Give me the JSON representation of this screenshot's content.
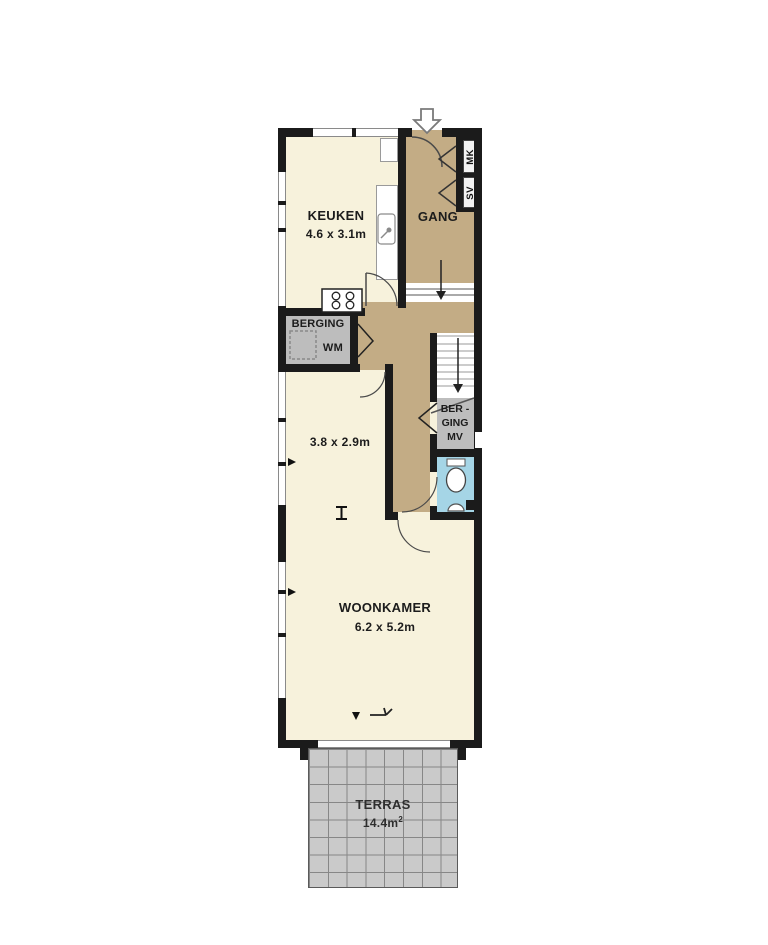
{
  "rooms": {
    "keuken": {
      "name": "KEUKEN",
      "dims": "4.6 x 3.1m"
    },
    "gang": {
      "name": "GANG"
    },
    "berging": {
      "name": "BERGING",
      "appliance": "WM"
    },
    "kamer": {
      "dims": "3.8 x 2.9m"
    },
    "berging_mv": {
      "line1": "BER -",
      "line2": "GING",
      "line3": "MV"
    },
    "woonkamer": {
      "name": "WOONKAMER",
      "dims": "6.2 x 5.2m"
    },
    "terras": {
      "name": "TERRAS",
      "area_value": "14.4m",
      "area_exp": "2"
    }
  },
  "closets": {
    "mk": "MK",
    "sv": "SV"
  },
  "colors": {
    "room_cream": "#f7f2dc",
    "hall_tan": "#c3ac85",
    "storage_gray": "#bdbdbd",
    "toilet_blue": "#a5d5e6",
    "terrace_gray": "#cacaca",
    "wall_black": "#1b1b1b"
  }
}
